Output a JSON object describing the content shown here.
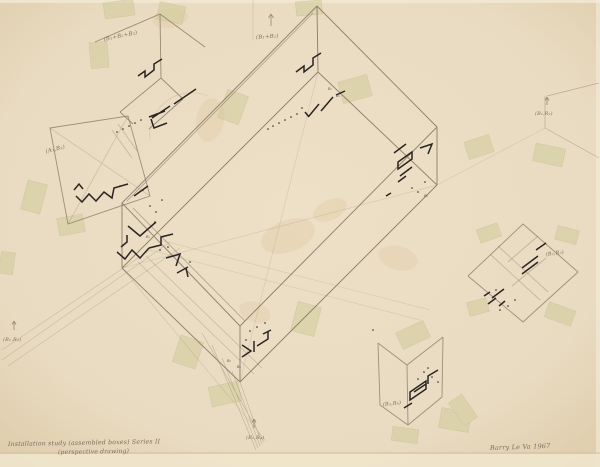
{
  "artwork": {
    "caption": {
      "line1": "Installation study (assembled boxes) Series II",
      "line2": "(perspective drawing)"
    },
    "signature": "Barry Le Va  1967",
    "labels": {
      "top_left": "(B₁+B₂+B₃)",
      "top_center": "(B₁+B₂)",
      "mid_left": "(A₁,B₂)",
      "left_edge": "(B₁,R₂)",
      "right_edge": "(B₂,R₂)",
      "right_diamond": "(B₂,R₃)",
      "bottom_right": "(B₃,R₄)",
      "bottom_center": "(B₁,R₄)"
    },
    "tiny_marks": {
      "b1": "B₁",
      "b2": "B₂",
      "b3": "B₃",
      "b4": "B₄",
      "r1": "R₁",
      "r2": "R₂"
    },
    "colors": {
      "paper": "#e9dbc1",
      "paper_edge": "#f1e8d0",
      "pencil": "#8a7d68",
      "ink": "#2a2522",
      "tape": "#d0cc9a",
      "handwriting": "#79705e"
    }
  }
}
